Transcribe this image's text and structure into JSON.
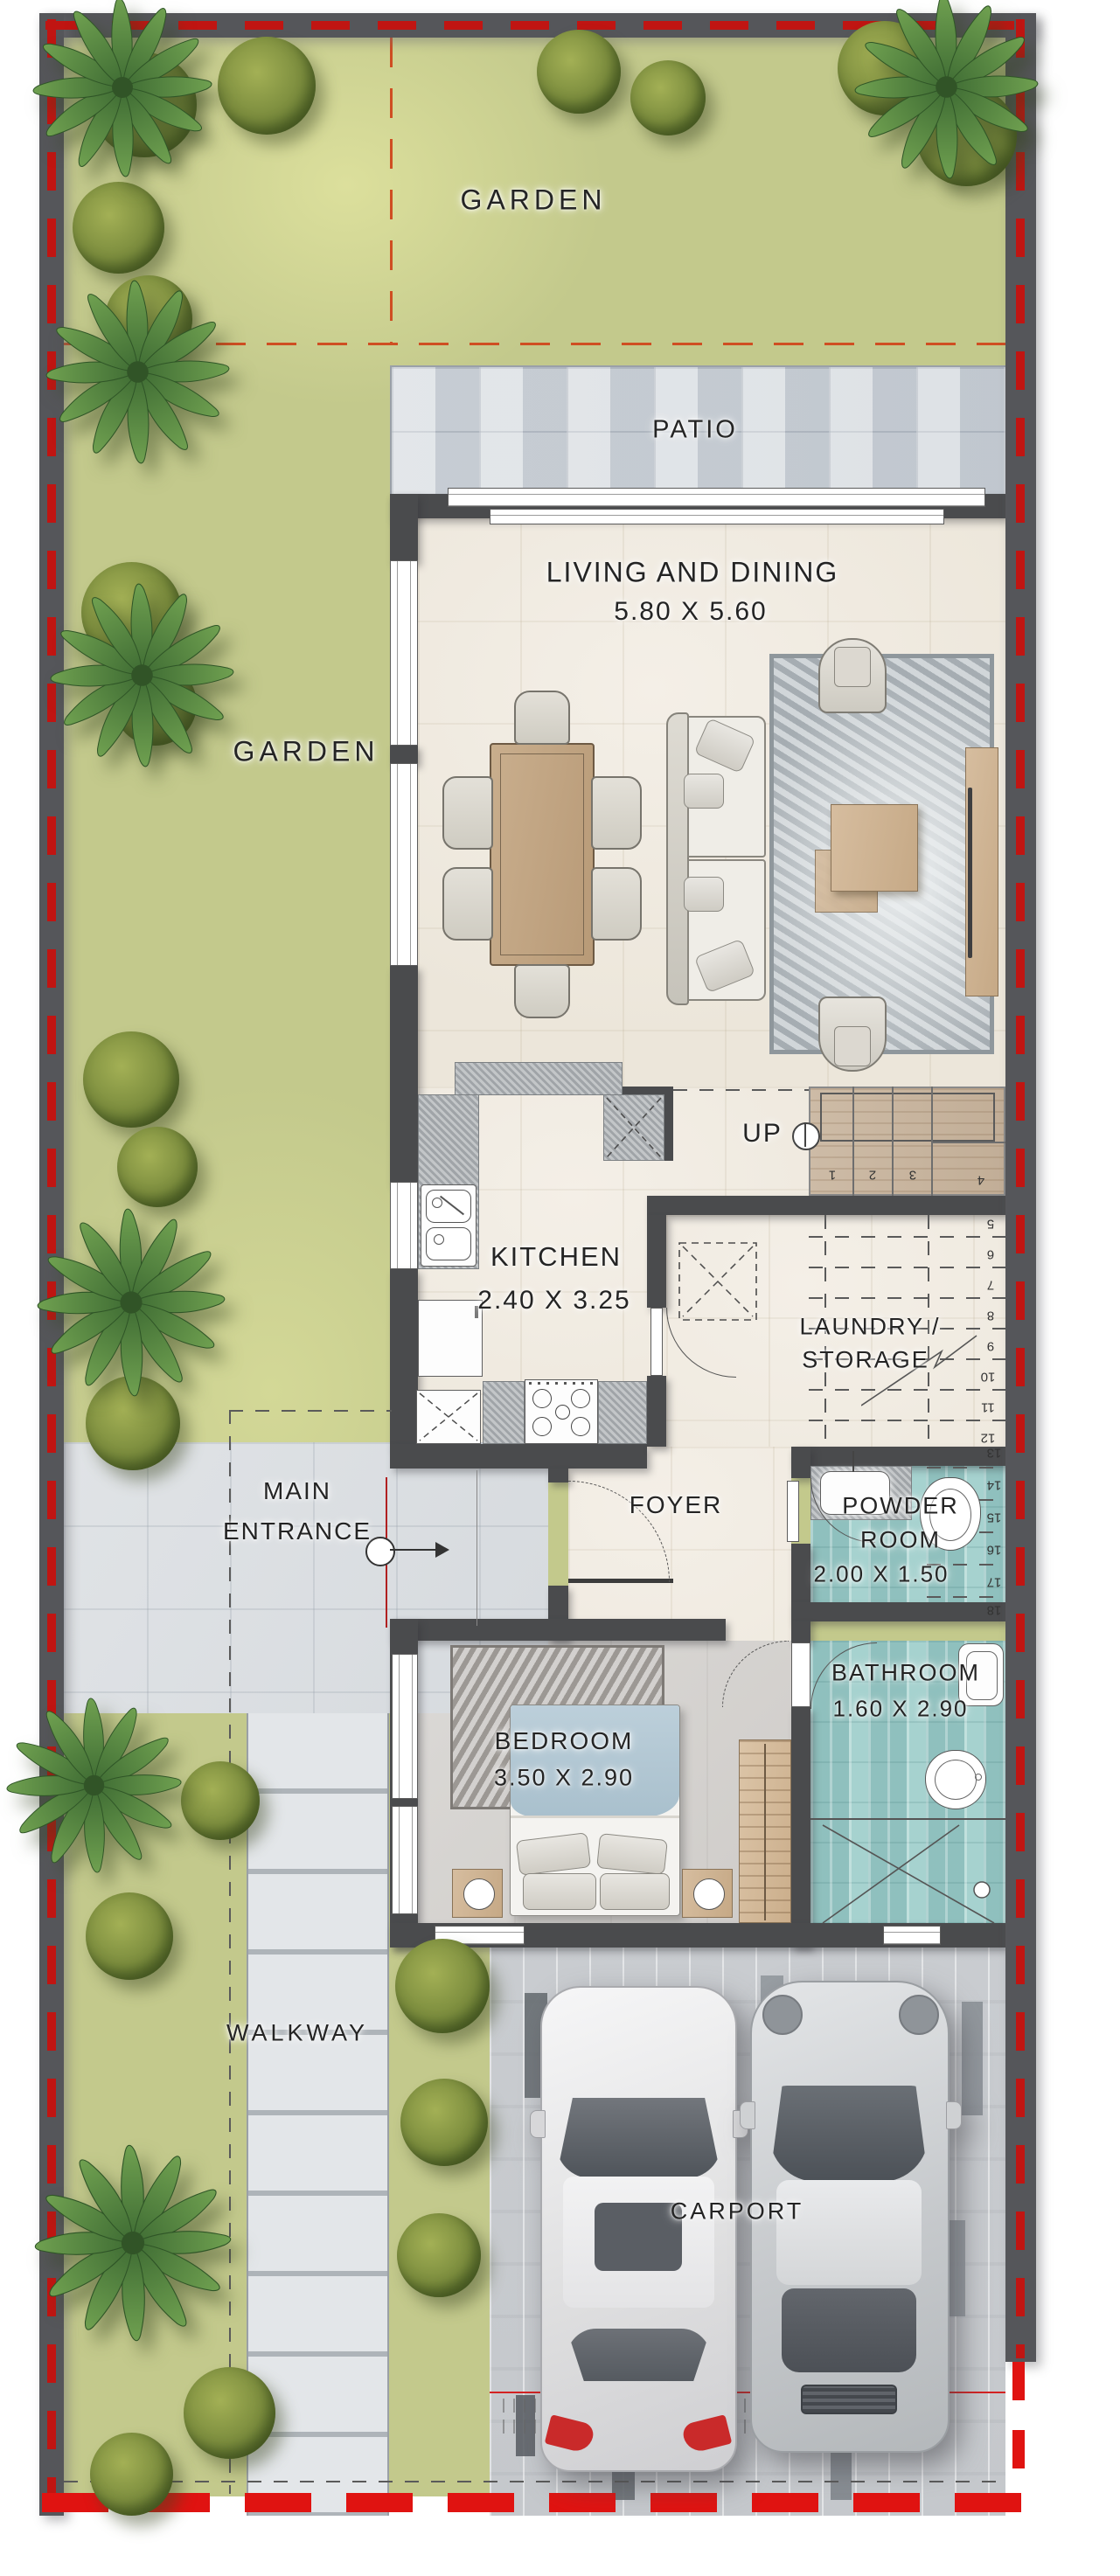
{
  "plan": {
    "type": "residential-floor-plan",
    "rooms": {
      "garden_top": {
        "label": "GARDEN"
      },
      "garden_left": {
        "label": "GARDEN"
      },
      "patio": {
        "label": "PATIO"
      },
      "living_dining": {
        "label": "LIVING AND DINING",
        "dimensions": "5.80 X 5.60"
      },
      "kitchen": {
        "label": "KITCHEN",
        "dimensions": "2.40 X 3.25"
      },
      "laundry_storage": {
        "label_line1": "LAUNDRY /",
        "label_line2": "STORAGE"
      },
      "powder_room": {
        "label_line1": "POWDER",
        "label_line2": "ROOM",
        "dimensions": "2.00 X 1.50"
      },
      "foyer": {
        "label": "FOYER"
      },
      "main_entrance": {
        "label_line1": "MAIN",
        "label_line2": "ENTRANCE"
      },
      "bedroom": {
        "label": "BEDROOM",
        "dimensions": "3.50 X 2.90"
      },
      "bathroom": {
        "label": "BATHROOM",
        "dimensions": "1.60 X 2.90"
      },
      "walkway": {
        "label": "WALKWAY"
      },
      "carport": {
        "label": "CARPORT"
      }
    },
    "stairs": {
      "up_label": "UP",
      "numbers_upper": [
        "1",
        "2",
        "3",
        "4"
      ],
      "numbers_mid": [
        "5",
        "6",
        "7",
        "8",
        "9",
        "10",
        "11",
        "12"
      ],
      "numbers_side": [
        "13",
        "14",
        "15",
        "16",
        "17",
        "18"
      ]
    },
    "colors": {
      "boundary_dash_red": "#c01512",
      "wall_dark": "#4a4b4d",
      "garden_green": "#c3c98c",
      "interior_cream": "#f0ebe2",
      "patio_gray": "#d0d5da",
      "wet_room_teal": "#a6d2cf",
      "stair_wood": "#c8b6a0",
      "divider_orange_dash": "#cf4e22"
    }
  }
}
